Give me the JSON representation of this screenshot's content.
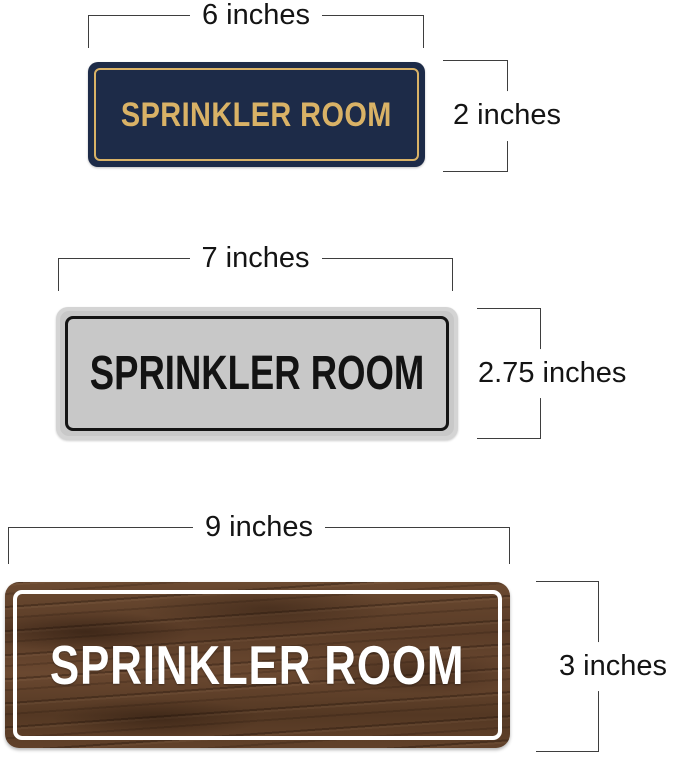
{
  "page": {
    "background": "#ffffff",
    "line_color": "#3e3e3e",
    "label_color": "#141414"
  },
  "signs": [
    {
      "id": "navy",
      "label": "SPRINKLER ROOM",
      "width_label": "6 inches",
      "height_label": "2 inches",
      "colors": {
        "face": "#1d2b48",
        "border": "#d9b266",
        "text": "#d9b266"
      }
    },
    {
      "id": "silver",
      "label": "SPRINKLER ROOM",
      "width_label": "7 inches",
      "height_label": "2.75 inches",
      "colors": {
        "face": "#c8c8c8",
        "rim": "#d4d4d4",
        "border": "#141414",
        "text": "#131313"
      }
    },
    {
      "id": "wood",
      "label": "SPRINKLER ROOM",
      "width_label": "9 inches",
      "height_label": "3 inches",
      "colors": {
        "face": "#5e4029",
        "border": "#ffffff",
        "text": "#ffffff"
      }
    }
  ]
}
